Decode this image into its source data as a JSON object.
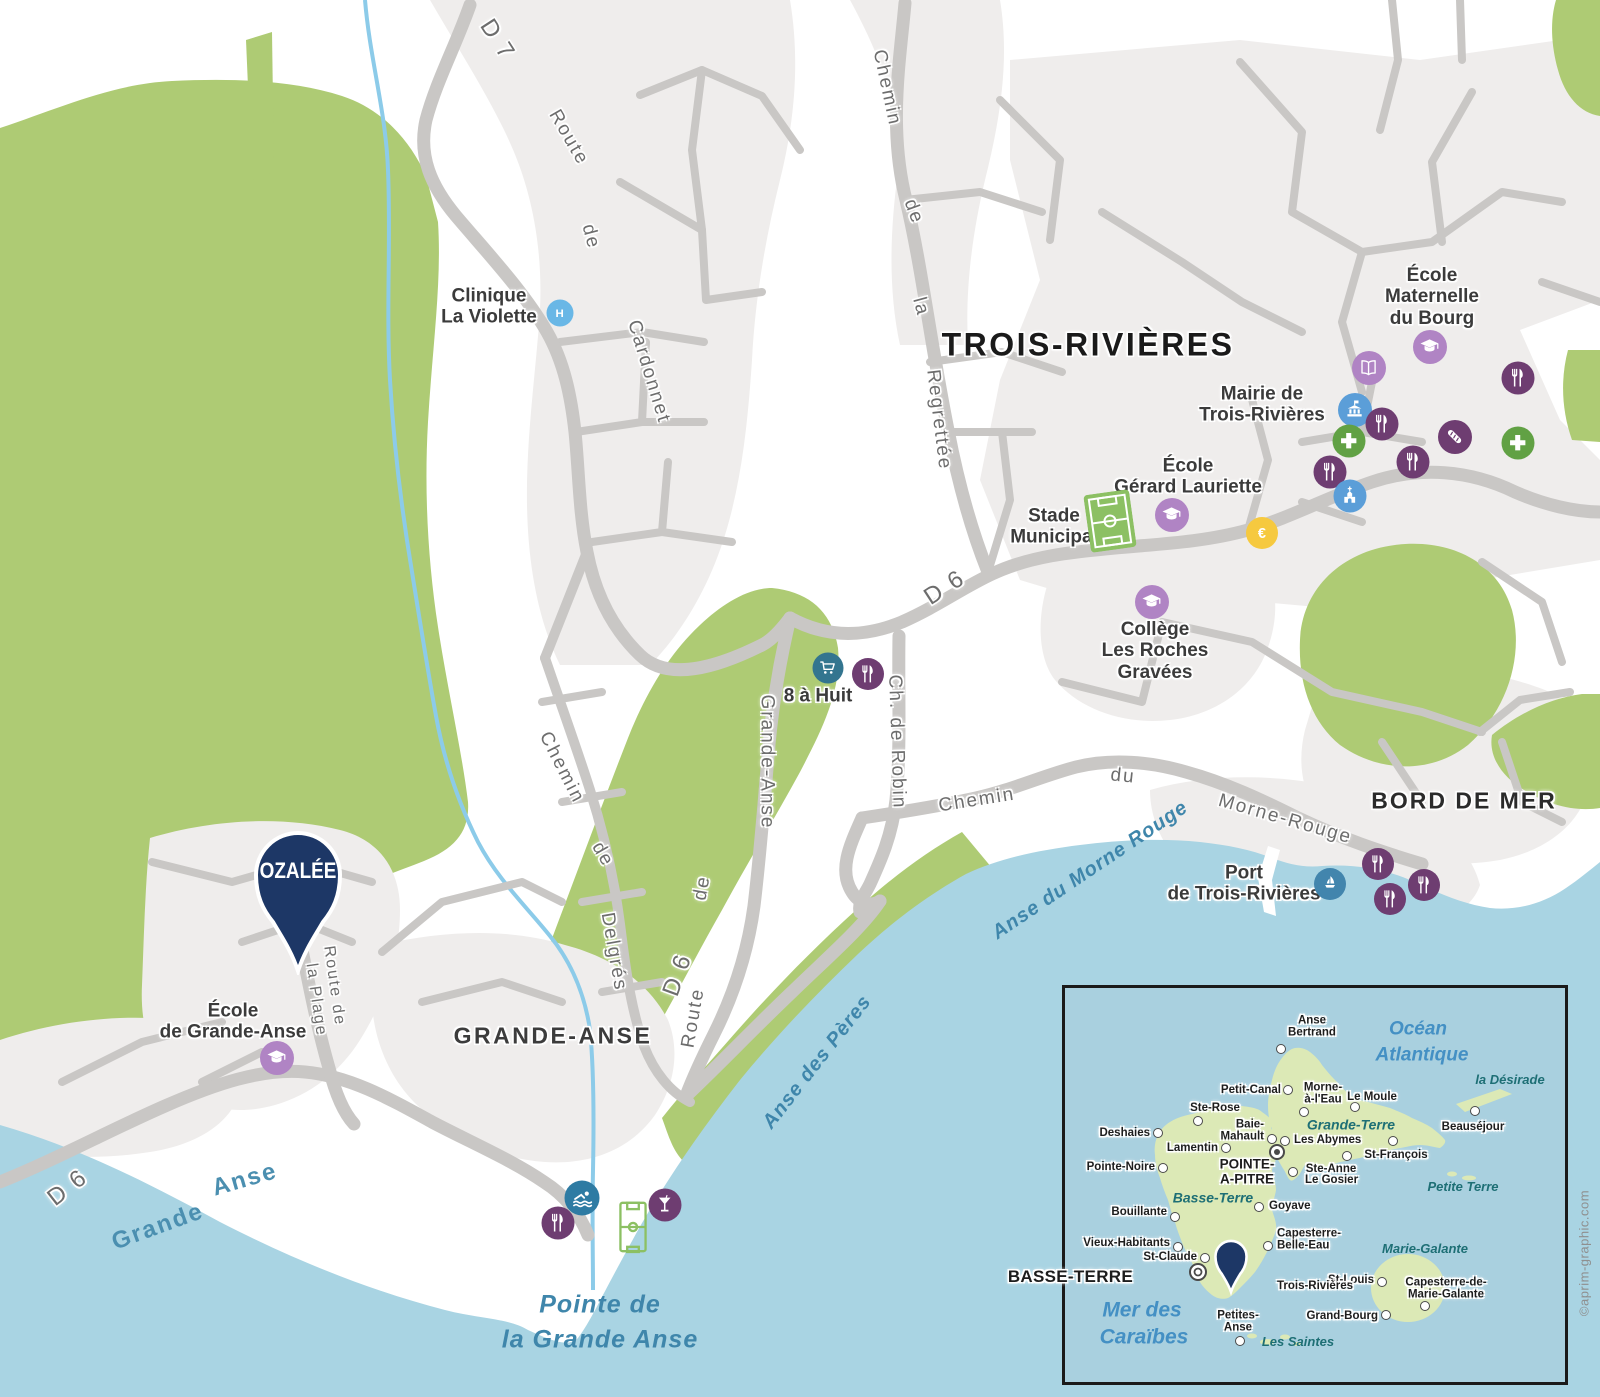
{
  "map": {
    "title": "TROIS-RIVIÈRES",
    "district_labels": [
      {
        "text": "TROIS-RIVIÈRES",
        "x": 1088,
        "y": 345,
        "size": 32,
        "weight": 800,
        "ls": 2.5,
        "color": "#1a1a1a"
      },
      {
        "text": "GRANDE-ANSE",
        "x": 553,
        "y": 1036,
        "size": 23,
        "weight": 600,
        "ls": 2.5,
        "color": "#3c3c3c"
      },
      {
        "text": "BORD DE MER",
        "x": 1464,
        "y": 801,
        "size": 23,
        "weight": 600,
        "ls": 2,
        "color": "#2b2b2b"
      }
    ],
    "road_labels": [
      {
        "text": "D 7",
        "x": 497,
        "y": 40,
        "rot": 57,
        "size": 24
      },
      {
        "text": "Route",
        "x": 568,
        "y": 138,
        "rot": 60,
        "size": 19
      },
      {
        "text": "de",
        "x": 590,
        "y": 237,
        "rot": 75,
        "size": 19
      },
      {
        "text": "Cardonnet",
        "x": 648,
        "y": 372,
        "rot": 73,
        "size": 19
      },
      {
        "text": "Chemin",
        "x": 886,
        "y": 88,
        "rot": 78,
        "size": 19
      },
      {
        "text": "de",
        "x": 913,
        "y": 212,
        "rot": 70,
        "size": 19
      },
      {
        "text": "la",
        "x": 920,
        "y": 307,
        "rot": 75,
        "size": 19
      },
      {
        "text": "Regrettée",
        "x": 938,
        "y": 420,
        "rot": 83,
        "size": 19
      },
      {
        "text": "Chemin",
        "x": 561,
        "y": 768,
        "rot": 63,
        "size": 19
      },
      {
        "text": "de",
        "x": 602,
        "y": 855,
        "rot": 60,
        "size": 19
      },
      {
        "text": "Delgrés",
        "x": 613,
        "y": 952,
        "rot": 80,
        "size": 19
      },
      {
        "text": "Grande-Anse",
        "x": 766,
        "y": 762,
        "rot": 90,
        "size": 19
      },
      {
        "text": "de",
        "x": 703,
        "y": 888,
        "rot": -80,
        "size": 19
      },
      {
        "text": "Route",
        "x": 694,
        "y": 1018,
        "rot": -80,
        "size": 19
      },
      {
        "text": "D 6",
        "x": 678,
        "y": 975,
        "rot": -70,
        "size": 24
      },
      {
        "text": "D 6",
        "x": 945,
        "y": 588,
        "rot": -33,
        "size": 24
      },
      {
        "text": "Ch. de Robin",
        "x": 896,
        "y": 742,
        "rot": 88,
        "size": 19
      },
      {
        "text": "Chemin",
        "x": 977,
        "y": 801,
        "rot": -9,
        "size": 19
      },
      {
        "text": "du",
        "x": 1123,
        "y": 777,
        "rot": 6,
        "size": 19
      },
      {
        "text": "Morne-Rouge",
        "x": 1285,
        "y": 820,
        "rot": 16,
        "size": 19
      },
      {
        "text": "D 6",
        "x": 68,
        "y": 1188,
        "rot": -38,
        "size": 24
      },
      {
        "text": "Route de",
        "x": 334,
        "y": 986,
        "rot": 82,
        "size": 16
      },
      {
        "text": "la Plage",
        "x": 316,
        "y": 1000,
        "rot": 82,
        "size": 16
      }
    ],
    "water_labels": [
      {
        "text": "Grande",
        "x": 158,
        "y": 1227,
        "rot": -20,
        "size": 24,
        "italic": false
      },
      {
        "text": "Anse",
        "x": 245,
        "y": 1180,
        "rot": -16,
        "size": 24,
        "italic": false
      },
      {
        "text": "Anse des Pères",
        "x": 817,
        "y": 1062,
        "rot": -52,
        "size": 20,
        "italic": true
      },
      {
        "text": "Anse du Morne Rouge",
        "x": 1090,
        "y": 870,
        "rot": -34,
        "size": 20,
        "italic": true
      },
      {
        "text": "Pointe de",
        "x": 600,
        "y": 1305,
        "rot": 0,
        "size": 25,
        "italic": true
      },
      {
        "text": "la Grande Anse",
        "x": 600,
        "y": 1340,
        "rot": 0,
        "size": 25,
        "italic": true
      }
    ],
    "pois": [
      {
        "lines": "Clinique\nLa Violette",
        "x": 489,
        "y": 307
      },
      {
        "lines": "École\nMaternelle\ndu Bourg",
        "x": 1432,
        "y": 297
      },
      {
        "lines": "Mairie de\nTrois-Rivières",
        "x": 1262,
        "y": 405
      },
      {
        "lines": "École\nGérard Lauriette",
        "x": 1188,
        "y": 477
      },
      {
        "lines": "Stade\nMunicipal",
        "x": 1054,
        "y": 527
      },
      {
        "lines": "Collège\nLes Roches\nGravées",
        "x": 1155,
        "y": 651
      },
      {
        "lines": "8 à Huit",
        "x": 818,
        "y": 696
      },
      {
        "lines": "Port\nde Trois-Rivières",
        "x": 1244,
        "y": 884
      },
      {
        "lines": "École\nde Grande-Anse",
        "x": 233,
        "y": 1022
      }
    ],
    "markers": [
      {
        "icon": "hospital",
        "x": 560,
        "y": 313,
        "d": 27,
        "bg": "#69b7e6"
      },
      {
        "icon": "school",
        "x": 1430,
        "y": 347,
        "d": 34,
        "bg": "#b084c4"
      },
      {
        "icon": "book",
        "x": 1369,
        "y": 368,
        "d": 34,
        "bg": "#b084c4"
      },
      {
        "icon": "townhall",
        "x": 1355,
        "y": 410,
        "d": 34,
        "bg": "#5b9ed8"
      },
      {
        "icon": "restaurant",
        "x": 1382,
        "y": 424,
        "d": 33,
        "bg": "#6e3d71"
      },
      {
        "icon": "cross",
        "x": 1349,
        "y": 441,
        "d": 33,
        "bg": "#61a144"
      },
      {
        "icon": "restaurant",
        "x": 1330,
        "y": 472,
        "d": 33,
        "bg": "#6e3d71"
      },
      {
        "icon": "church",
        "x": 1350,
        "y": 496,
        "d": 33,
        "bg": "#5b9ed8"
      },
      {
        "icon": "restaurant",
        "x": 1413,
        "y": 462,
        "d": 33,
        "bg": "#6e3d71"
      },
      {
        "icon": "baguette",
        "x": 1455,
        "y": 437,
        "d": 34,
        "bg": "#6e3d71"
      },
      {
        "icon": "cross",
        "x": 1518,
        "y": 443,
        "d": 33,
        "bg": "#61a144"
      },
      {
        "icon": "restaurant",
        "x": 1518,
        "y": 378,
        "d": 33,
        "bg": "#6e3d71"
      },
      {
        "icon": "school",
        "x": 1172,
        "y": 515,
        "d": 34,
        "bg": "#b084c4"
      },
      {
        "icon": "euro",
        "x": 1262,
        "y": 533,
        "d": 32,
        "bg": "#f6c93f"
      },
      {
        "icon": "school",
        "x": 1152,
        "y": 602,
        "d": 34,
        "bg": "#b084c4"
      },
      {
        "icon": "cart",
        "x": 828,
        "y": 668,
        "d": 31,
        "bg": "#33758f"
      },
      {
        "icon": "restaurant",
        "x": 868,
        "y": 674,
        "d": 32,
        "bg": "#6e3d71"
      },
      {
        "icon": "sailboat",
        "x": 1330,
        "y": 884,
        "d": 32,
        "bg": "#4285ad"
      },
      {
        "icon": "restaurant",
        "x": 1378,
        "y": 864,
        "d": 32,
        "bg": "#6e3d71"
      },
      {
        "icon": "restaurant",
        "x": 1424,
        "y": 885,
        "d": 32,
        "bg": "#6e3d71"
      },
      {
        "icon": "restaurant",
        "x": 1390,
        "y": 899,
        "d": 32,
        "bg": "#6e3d71"
      },
      {
        "icon": "swim",
        "x": 582,
        "y": 1198,
        "d": 35,
        "bg": "#2e7ba3"
      },
      {
        "icon": "restaurant",
        "x": 558,
        "y": 1223,
        "d": 33,
        "bg": "#6e3d71"
      },
      {
        "icon": "cocktail",
        "x": 665,
        "y": 1205,
        "d": 33,
        "bg": "#6e3d71"
      },
      {
        "icon": "school",
        "x": 277,
        "y": 1058,
        "d": 34,
        "bg": "#b084c4"
      },
      {
        "icon": "pitch-filled",
        "x": 1110,
        "y": 521,
        "w": 46,
        "h": 58,
        "rot": -8
      },
      {
        "icon": "pitch-outline",
        "x": 633,
        "y": 1227,
        "w": 29,
        "h": 53,
        "rot": 0
      }
    ],
    "pin": {
      "label": "OZALÉE",
      "x": 298,
      "y": 873
    }
  },
  "inset": {
    "sea_labels": [
      {
        "text": "Océan",
        "x": 1418,
        "y": 1030,
        "size": 19
      },
      {
        "text": "Atlantique",
        "x": 1422,
        "y": 1056,
        "size": 19
      },
      {
        "text": "Mer des",
        "x": 1142,
        "y": 1310,
        "size": 21
      },
      {
        "text": "Caraïbes",
        "x": 1144,
        "y": 1337,
        "size": 21
      }
    ],
    "island_labels": [
      {
        "text": "Grande-Terre",
        "x": 1351,
        "y": 1125,
        "size": 14
      },
      {
        "text": "Basse-Terre",
        "x": 1213,
        "y": 1198,
        "size": 14
      },
      {
        "text": "la Désirade",
        "x": 1510,
        "y": 1080,
        "size": 13
      },
      {
        "text": "Petite Terre",
        "x": 1463,
        "y": 1187,
        "size": 13
      },
      {
        "text": "Marie-Galante",
        "x": 1425,
        "y": 1249,
        "size": 13
      },
      {
        "text": "Les Saintes",
        "x": 1298,
        "y": 1342,
        "size": 13
      }
    ],
    "towns": [
      {
        "name": "Anse\nBertrand",
        "dot": [
          1281,
          1049
        ],
        "label": [
          1312,
          1027
        ],
        "align": "center"
      },
      {
        "name": "Petit-Canal",
        "dot": [
          1288,
          1090
        ],
        "label": [
          1281,
          1090
        ],
        "align": "right"
      },
      {
        "name": "Morne-\nà-l'Eau",
        "dot": [
          1304,
          1112
        ],
        "label": [
          1323,
          1094
        ],
        "align": "center"
      },
      {
        "name": "Le Moule",
        "dot": [
          1355,
          1107
        ],
        "label": [
          1372,
          1097
        ],
        "align": "center"
      },
      {
        "name": "Ste-Rose",
        "dot": [
          1198,
          1121
        ],
        "label": [
          1215,
          1108
        ],
        "align": "center"
      },
      {
        "name": "Deshaies",
        "dot": [
          1158,
          1133
        ],
        "label": [
          1150,
          1133
        ],
        "align": "right"
      },
      {
        "name": "Lamentin",
        "dot": [
          1226,
          1148
        ],
        "label": [
          1218,
          1148
        ],
        "align": "right"
      },
      {
        "name": "Baie-\nMahault",
        "dot": [
          1272,
          1139
        ],
        "label": [
          1264,
          1131
        ],
        "align": "right"
      },
      {
        "name": "Les Abymes",
        "dot": [
          1285,
          1141
        ],
        "label": [
          1294,
          1140
        ],
        "align": "left"
      },
      {
        "name": "St-François",
        "dot": [
          1393,
          1141
        ],
        "label": [
          1396,
          1155
        ],
        "align": "center"
      },
      {
        "name": "Ste-Anne",
        "dot": [
          1347,
          1156
        ],
        "label": [
          1331,
          1169
        ],
        "align": "center"
      },
      {
        "name": "Le Gosier",
        "dot": [
          1293,
          1172
        ],
        "label": [
          1305,
          1180
        ],
        "align": "left"
      },
      {
        "name": "Beauséjour",
        "dot": [
          1475,
          1111
        ],
        "label": [
          1473,
          1127
        ],
        "align": "center"
      },
      {
        "name": "Pointe-Noire",
        "dot": [
          1163,
          1168
        ],
        "label": [
          1155,
          1167
        ],
        "align": "right"
      },
      {
        "name": "Bouillante",
        "dot": [
          1175,
          1217
        ],
        "label": [
          1167,
          1212
        ],
        "align": "right"
      },
      {
        "name": "Goyave",
        "dot": [
          1259,
          1207
        ],
        "label": [
          1269,
          1206
        ],
        "align": "left"
      },
      {
        "name": "Vieux-Habitants",
        "dot": [
          1178,
          1247
        ],
        "label": [
          1170,
          1243
        ],
        "align": "right"
      },
      {
        "name": "St-Claude",
        "dot": [
          1205,
          1258
        ],
        "label": [
          1197,
          1257
        ],
        "align": "right"
      },
      {
        "name": "Capesterre-\nBelle-Eau",
        "dot": [
          1268,
          1246
        ],
        "label": [
          1277,
          1240
        ],
        "align": "left"
      },
      {
        "name": "Petites-\nAnse",
        "dot": [
          1240,
          1341
        ],
        "label": [
          1238,
          1322
        ],
        "align": "center"
      },
      {
        "name": "Grand-Bourg",
        "dot": [
          1386,
          1315
        ],
        "label": [
          1378,
          1316
        ],
        "align": "right"
      },
      {
        "name": "St-Louis",
        "dot": [
          1382,
          1282
        ],
        "label": [
          1374,
          1280
        ],
        "align": "right"
      },
      {
        "name": "Capesterre-de-\nMarie-Galante",
        "dot": [
          1425,
          1306
        ],
        "label": [
          1446,
          1289
        ],
        "align": "center"
      },
      {
        "name": "POINTE-\nA-PITRE",
        "type": "prefecture",
        "label": [
          1247,
          1172
        ],
        "align": "center"
      },
      {
        "name": "BASSE-TERRE",
        "type": "capital",
        "label": [
          1133,
          1277
        ],
        "align": "right"
      },
      {
        "name": "Trois-Rivières",
        "type": "pin",
        "label": [
          1277,
          1286
        ],
        "align": "left"
      }
    ]
  },
  "credit": "©aprim-graphic.com",
  "colors": {
    "vegetation": "#aecb74",
    "sea": "#a9d4e3",
    "urban": "#efedec",
    "road": "#c9c7c5",
    "stream": "#8ccbe9",
    "pin_navy": "#1d3766",
    "school_lilac": "#b084c4",
    "restaurant_purple": "#6e3d71",
    "civic_blue": "#5b9ed8",
    "pharmacy_green": "#61a144",
    "bank_yellow": "#f6c93f",
    "port_blue": "#4285ad",
    "market_teal": "#33758f",
    "hospital_blue": "#69b7e6",
    "inset_land": "#dce9b6",
    "inset_sea": "#a9d0df",
    "pitch_green": "#8cc063"
  }
}
